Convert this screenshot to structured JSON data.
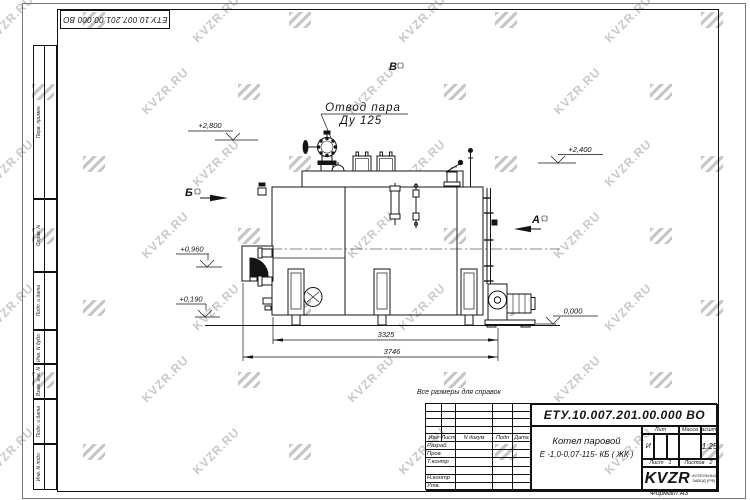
{
  "watermark": {
    "text": "KVZR.RU"
  },
  "stamp_top": {
    "doc_number_rotated": "ЕТУ.10.007.201.00.000  ВО"
  },
  "margin_labels": [
    "Перв. примен.",
    "Справ. N",
    "Подп. и дата",
    "Инв. N дубл.",
    "Взам. инв. N",
    "Подп. и дата",
    "Инв. N подл."
  ],
  "note": "Все размеры для справок",
  "drawing": {
    "callout": {
      "line1": "Отвод пара",
      "line2": "Ду 125"
    },
    "views": {
      "a": "А",
      "b": "Б",
      "v": "В"
    },
    "elevations": {
      "e2800": "+2,800",
      "e2400": "+2,400",
      "e0960": "+0,960",
      "e0190": "+0,190",
      "e0000": "0,000"
    },
    "dims": {
      "inner": "3325",
      "overall": "3746"
    }
  },
  "title_block": {
    "doc_number": "ЕТУ.10.007.201.00.000  ВО",
    "name_line1": "Котел паровой",
    "name_line2": "Е -1,0-0,07-115- КБ ( ЖК )",
    "headers": {
      "izm": "Изм",
      "list": "Лист",
      "n_dokum": "N докум",
      "podp": "Подп",
      "data": "Дата",
      "lit": "Лит",
      "massa": "Масса",
      "masshtab": "Масштаб"
    },
    "rows": [
      "Разраб.",
      "Пров.",
      "Т.контр",
      "",
      "Н.контр",
      "Утв."
    ],
    "lit_value": "И",
    "scale": "1:25",
    "sheet_label": "Лист",
    "sheet_value": "1",
    "sheets_label": "Листов",
    "sheets_value": "2",
    "logo": "KVZR",
    "logo_sub1": "КОТЕЛЬНЫЙ",
    "logo_sub2": "ЗАВОД (РФ)",
    "format": "Формат А3"
  }
}
